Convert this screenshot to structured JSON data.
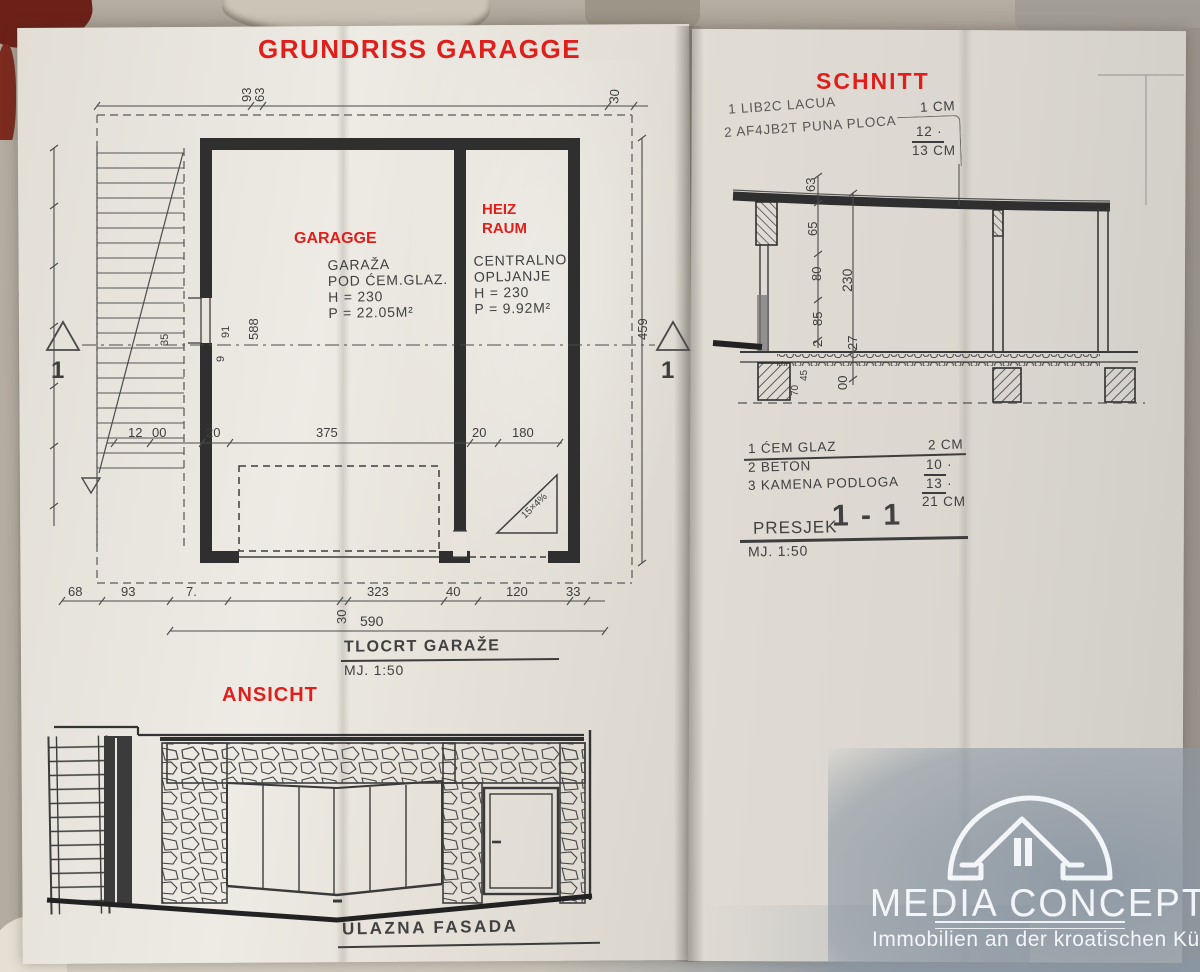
{
  "colors": {
    "red": "#e01f1c",
    "ink": "#3e3e3e",
    "paper": "#e9e5dd",
    "watermark_blue": "#8b97a3"
  },
  "titles": {
    "plan": "GRUNDRISS  GARAGGE",
    "section": "SCHNITT",
    "elevation": "ANSICHT"
  },
  "overlays": {
    "garage": "GARAGGE",
    "heiz1": "HEIZ",
    "heiz2": "RAUM"
  },
  "plan": {
    "garage": {
      "l1": "GARAŽA",
      "l2": "POD ĆEM.GLAZ.",
      "l3": "H = 230",
      "l4": "P = 22.05M²"
    },
    "heating": {
      "l1": "CENTRALNO",
      "l2": "OPLJANJE",
      "l3": "H = 230",
      "l4": "P = 9.92M²"
    },
    "caption": {
      "title": "TLOCRT GARAŽE",
      "scale": "MJ.  1:50"
    },
    "marker": "1",
    "dims": {
      "top_a": "93",
      "top_b": "63",
      "top_right": "30",
      "mid": [
        "12",
        "00",
        "20",
        "375",
        "20",
        "180"
      ],
      "bottom": [
        "68",
        "93",
        "7.",
        "30",
        "323",
        "40",
        "120",
        "33"
      ],
      "total": "590",
      "left_a": "588",
      "left_b": "91",
      "left_c": "35",
      "left_d": "9",
      "right": "459",
      "ramp": "15×4%"
    }
  },
  "section": {
    "notes_top": {
      "l1": "1 LIB2C LACUA",
      "v1": "1 CM",
      "l2": "2 AF4JB2T PUNA PLOCA",
      "v2": "12 ·",
      "v3": "13 CM"
    },
    "notes": {
      "l1": "1 ĆEM GLAZ",
      "v1": "2 CM",
      "l2": "2 BETON",
      "v2": "10 ·",
      "l3": "3 KAMENA PODLOGA",
      "v3": "13 ·",
      "v4": "21 CM"
    },
    "caption": {
      "title": "PRESJEK",
      "num": "1 - 1",
      "scale": "MJ. 1:50"
    },
    "dims": {
      "chain": [
        "63",
        "65",
        "80",
        "85",
        "2"
      ],
      "overall": "230",
      "floor": "27",
      "below": "00",
      "fa": "70",
      "fb": "45"
    }
  },
  "elevation": {
    "caption": "ULAZNA FASADA"
  },
  "brand": {
    "name": "MEDIA CONCEPT",
    "tagline": "Immobilien an der kroatischen Küste"
  }
}
